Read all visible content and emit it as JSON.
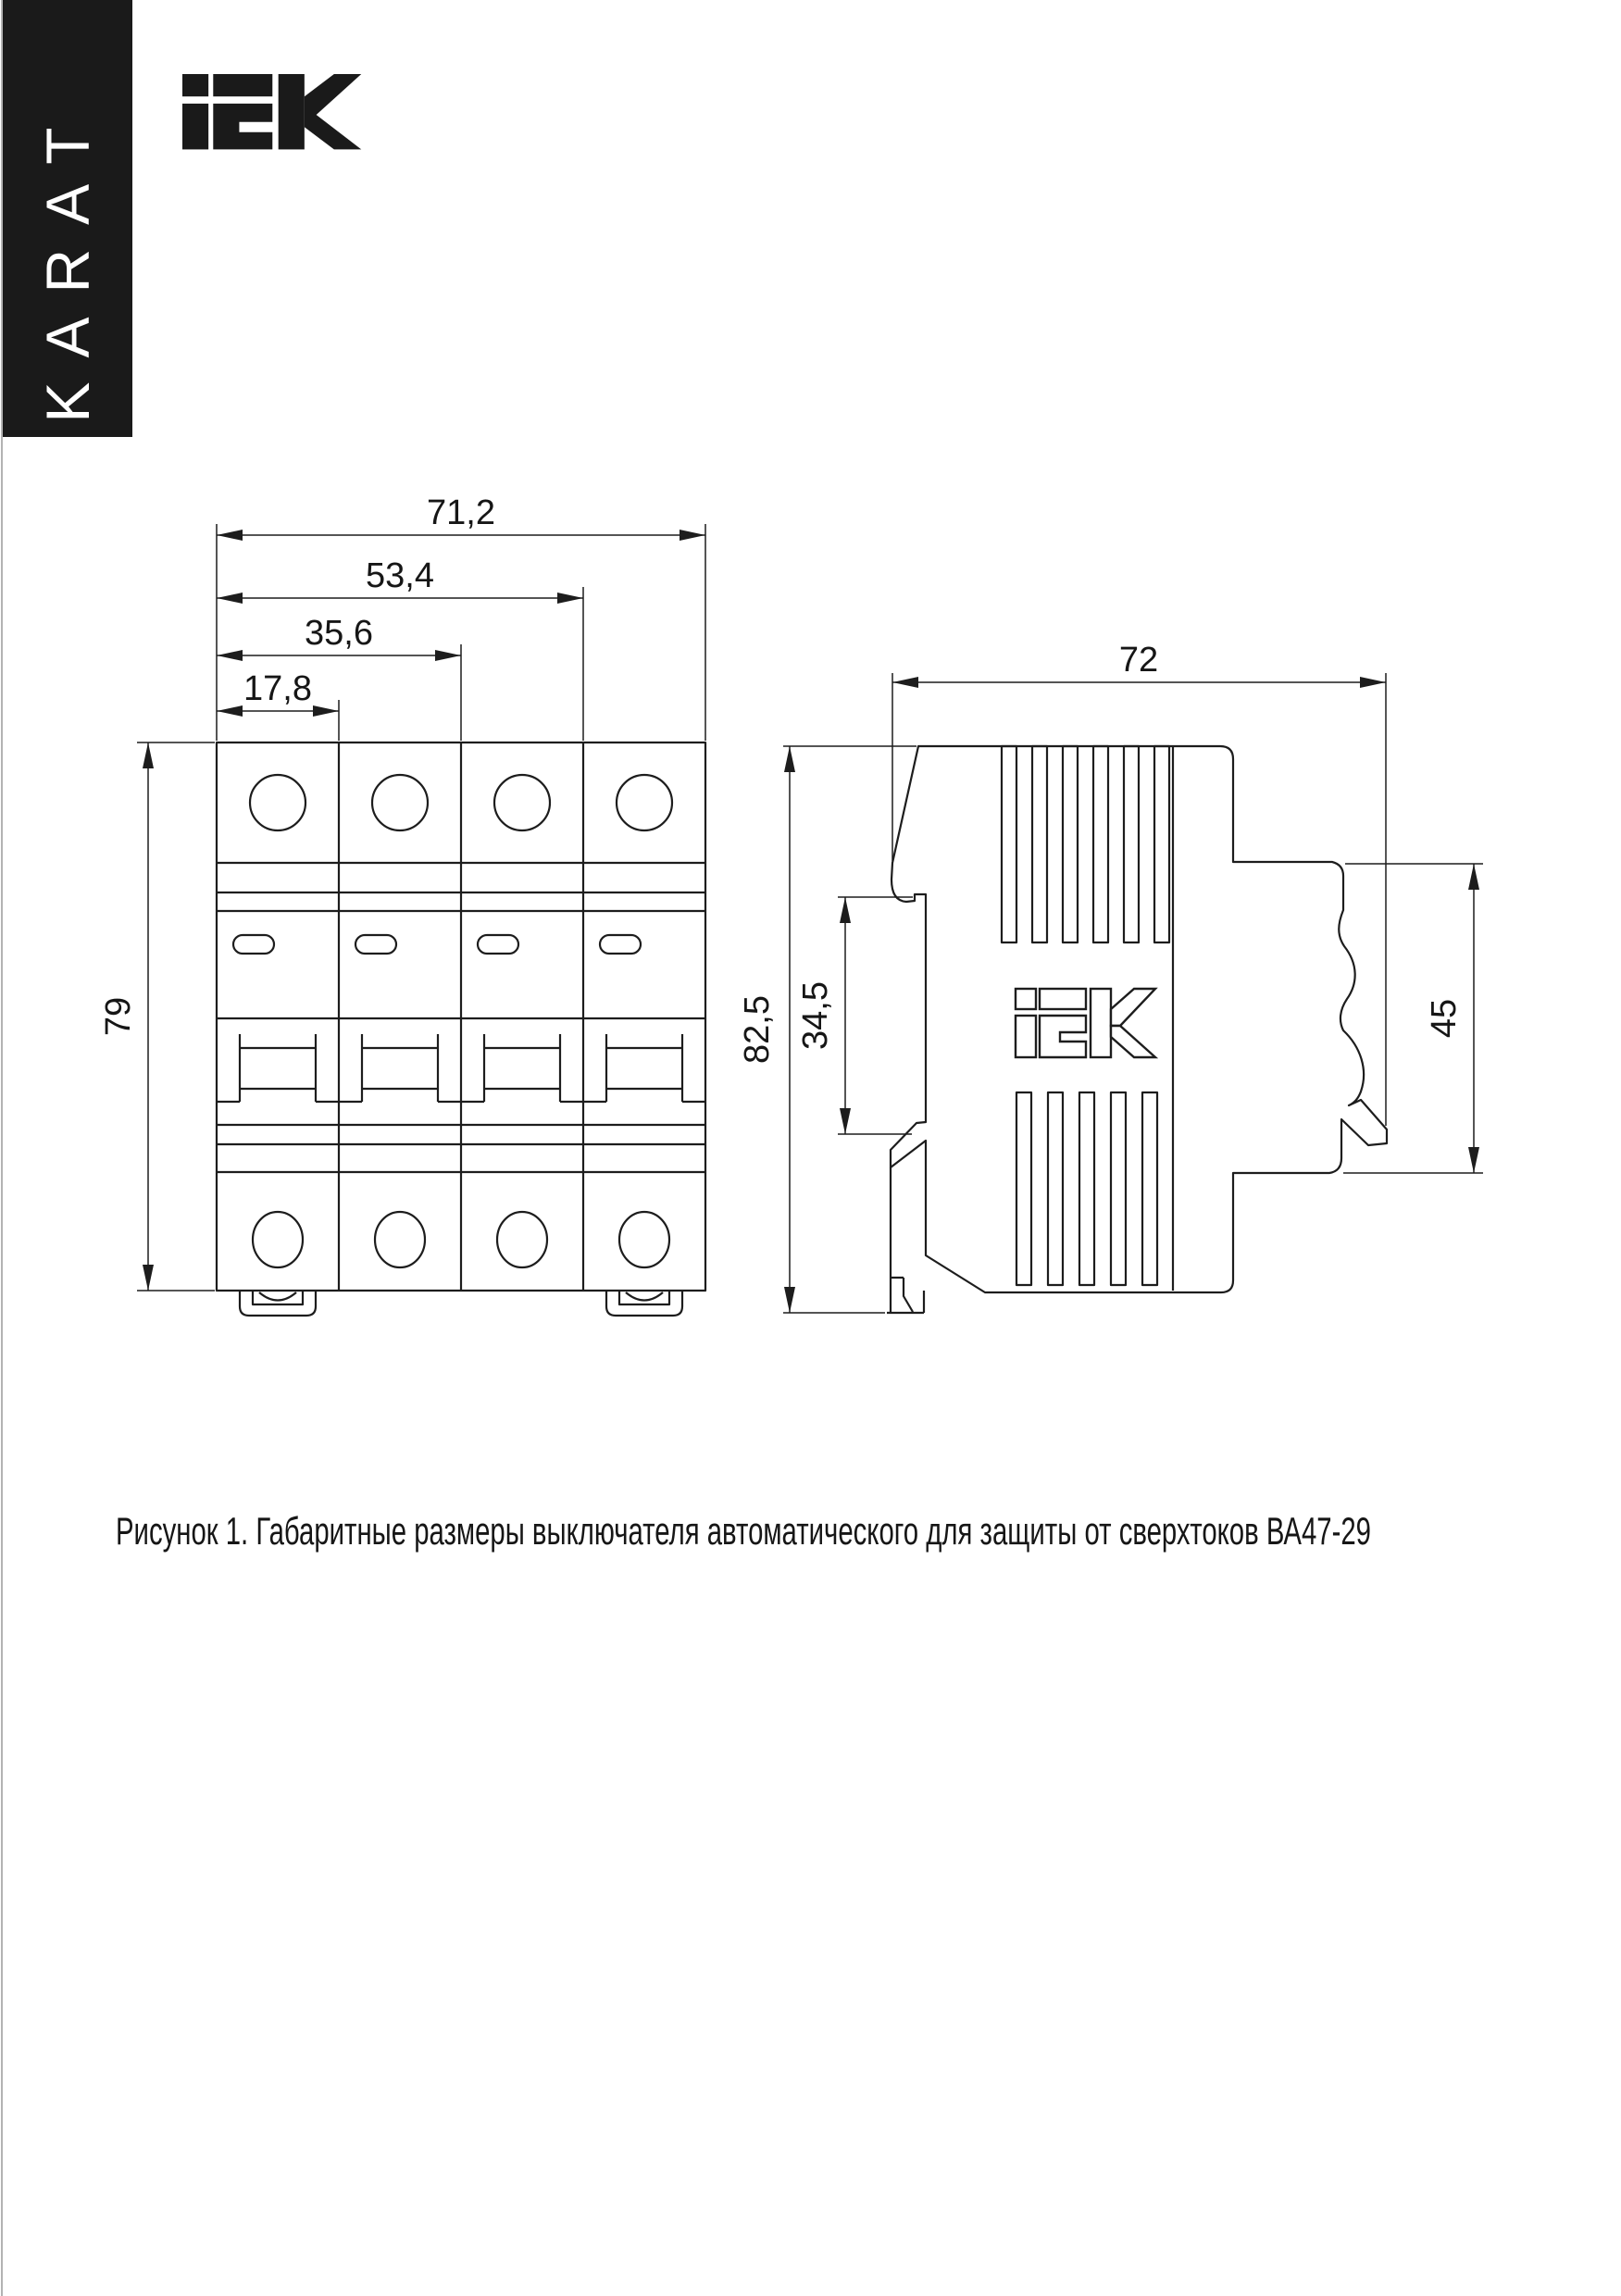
{
  "brand": {
    "vertical_label": "KARAT",
    "logo_name": "IEK"
  },
  "drawing": {
    "caption": "Рисунок 1. Габаритные размеры выключателя автоматического для защиты от сверхтоков ВА47-29",
    "dims": {
      "front_total_width": "71,2",
      "front_three_modules": "53,4",
      "front_two_modules": "35,6",
      "front_one_module": "17,8",
      "front_height": "79",
      "side_depth": "72",
      "side_total_height": "82,5",
      "side_rail_zone_height": "34,5",
      "side_front_height": "45"
    }
  }
}
